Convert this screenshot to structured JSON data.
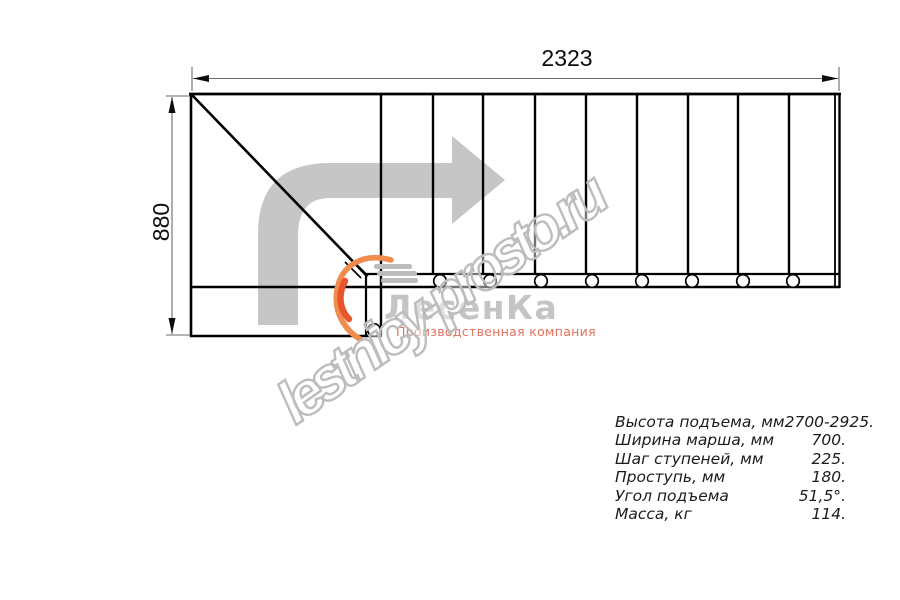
{
  "drawing": {
    "dimension_top": "2323",
    "dimension_left": "880"
  },
  "watermark": {
    "text": "lestnicy-prosto.ru"
  },
  "logo": {
    "name": "ЛесенКа",
    "tagline": "Производственная компания"
  },
  "specifications": {
    "rows": [
      {
        "label": "Высота подъема, мм",
        "value": "2700-2925."
      },
      {
        "label": "Ширина марша, мм",
        "value": "700."
      },
      {
        "label": "Шаг ступеней, мм",
        "value": "225."
      },
      {
        "label": "Проступь, мм",
        "value": "180."
      },
      {
        "label": "Угол подъема",
        "value": "51,5°."
      },
      {
        "label": "Масса, кг",
        "value": "114."
      }
    ]
  },
  "colors": {
    "line": "#000000",
    "direction_arrow": "#c6c6c6",
    "watermark_outline": "#bdbdbd",
    "logo_text": "#c4c4c4",
    "logo_flame": "#ee6f3a",
    "logo_tagline": "#e4705c"
  }
}
